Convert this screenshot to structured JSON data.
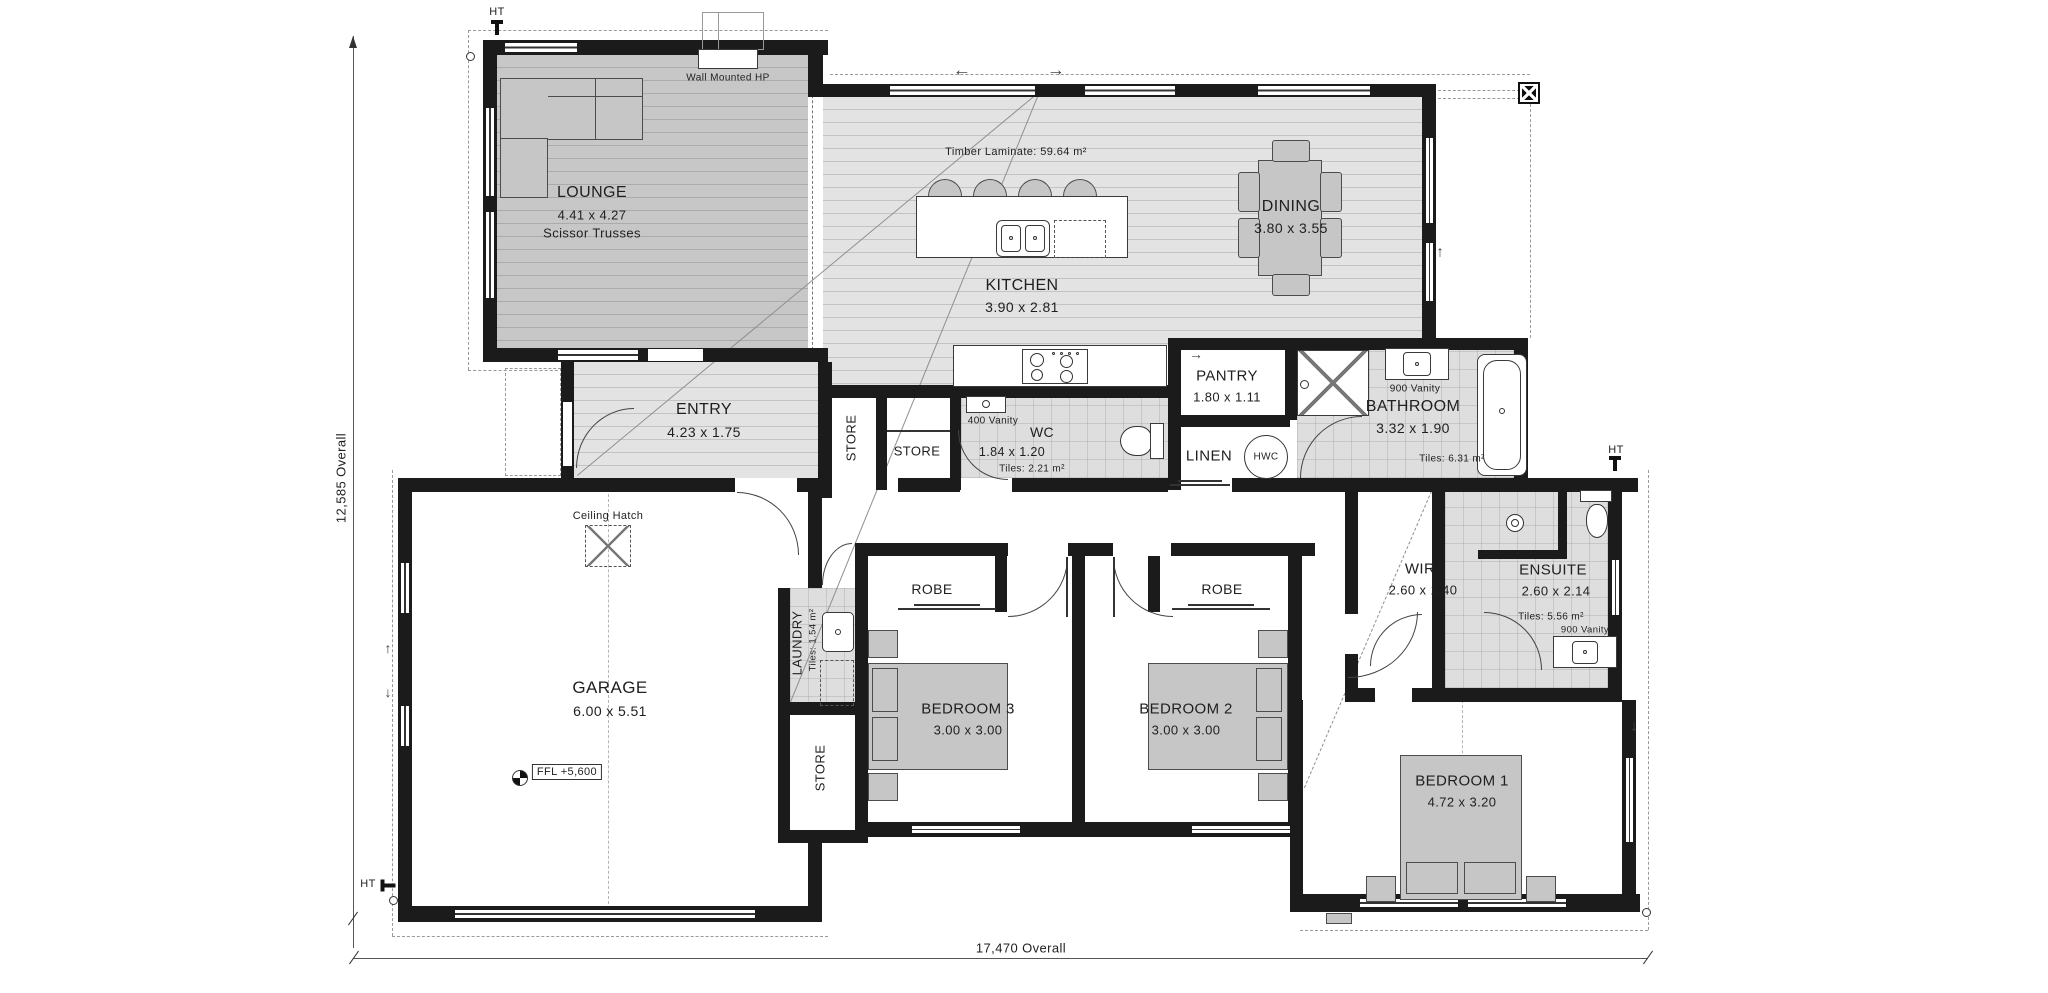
{
  "plan": {
    "dims": {
      "height_overall": "12,585 Overall",
      "width_overall": "17,470 Overall"
    },
    "markers": {
      "ht": "HT",
      "ffl": "FFL +5,600",
      "ceiling_hatch": "Ceiling Hatch",
      "wall_mounted_hp": "Wall Mounted HP",
      "timber_laminate": "Timber Laminate: 59.64 m²"
    },
    "icons": {
      "arrow_left": "←",
      "arrow_right": "→",
      "arrow_up": "↑",
      "arrow_down": "↓"
    },
    "rooms": {
      "lounge": {
        "name": "LOUNGE",
        "size": "4.41 x 4.27",
        "note": "Scissor Trusses"
      },
      "kitchen": {
        "name": "KITCHEN",
        "size": "3.90 x 2.81"
      },
      "dining": {
        "name": "DINING",
        "size": "3.80 x 3.55"
      },
      "entry": {
        "name": "ENTRY",
        "size": "4.23 x 1.75"
      },
      "store_hall": {
        "name": "STORE"
      },
      "store_mid": {
        "name": "STORE"
      },
      "store_laundry": {
        "name": "STORE"
      },
      "wc": {
        "name": "WC",
        "size": "1.84 x 1.20",
        "tiles": "Tiles: 2.21 m²",
        "vanity": "400 Vanity"
      },
      "pantry": {
        "name": "PANTRY",
        "size": "1.80 x 1.11"
      },
      "linen": {
        "name": "LINEN"
      },
      "hwc": {
        "name": "HWC"
      },
      "bathroom": {
        "name": "BATHROOM",
        "size": "3.32 x 1.90",
        "tiles": "Tiles: 6.31 m²",
        "vanity": "900 Vanity"
      },
      "garage": {
        "name": "GARAGE",
        "size": "6.00 x 5.51"
      },
      "laundry": {
        "name": "LAUNDRY",
        "tiles": "Tiles: 1.54 m²"
      },
      "robe3": {
        "name": "ROBE"
      },
      "robe2": {
        "name": "ROBE"
      },
      "bedroom3": {
        "name": "BEDROOM 3",
        "size": "3.00 x 3.00"
      },
      "bedroom2": {
        "name": "BEDROOM 2",
        "size": "3.00 x 3.00"
      },
      "bedroom1": {
        "name": "BEDROOM 1",
        "size": "4.72 x 3.20"
      },
      "wir": {
        "name": "WIR",
        "size": "2.60 x 1.40"
      },
      "ensuite": {
        "name": "ENSUITE",
        "size": "2.60 x 2.14",
        "tiles": "Tiles: 5.56 m²",
        "vanity": "900 Vanity"
      }
    }
  }
}
